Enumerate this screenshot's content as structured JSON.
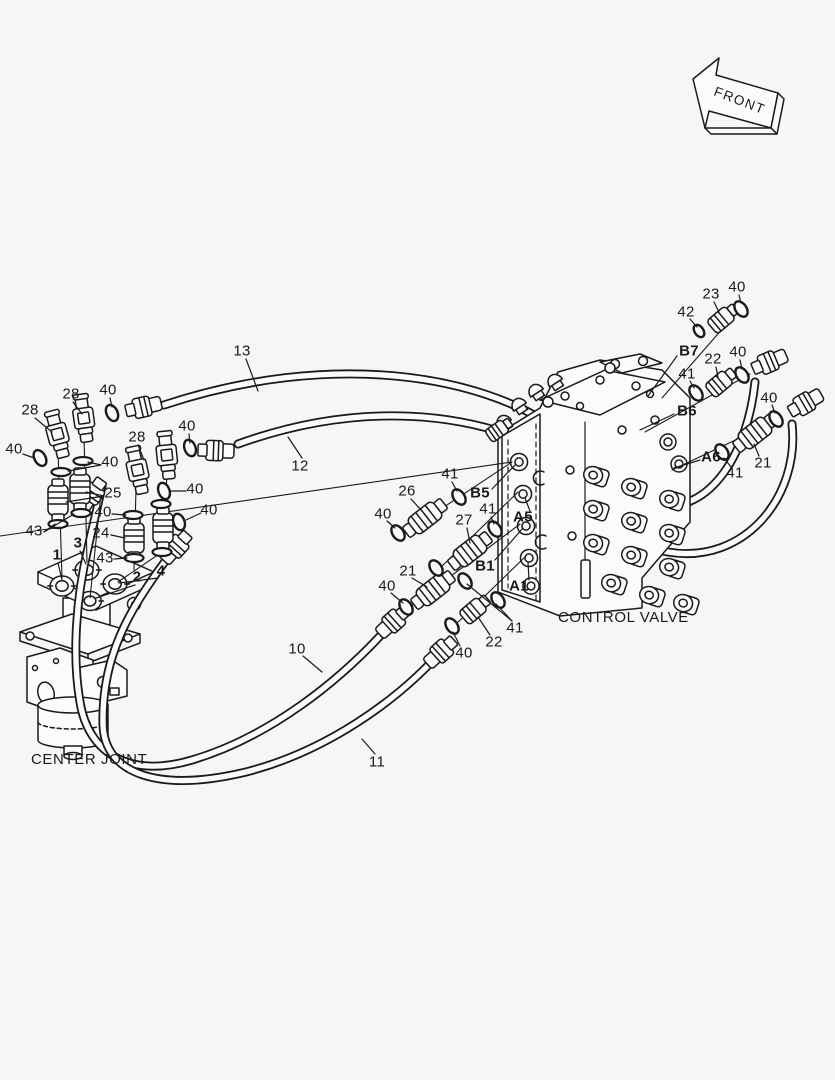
{
  "annotations": {
    "front_arrow": "FRONT",
    "center_joint": "CENTER JOINT",
    "control_valve": "CONTROL VALVE"
  },
  "colors": {
    "line": "#1a1a1a",
    "background": "#f6f6f4",
    "fill": "#fbfbfa"
  },
  "captions": [
    {
      "key": "center_joint",
      "text": "CENTER JOINT",
      "x": 31,
      "y": 752
    },
    {
      "key": "control_valve",
      "text": "CONTROL VALVE",
      "x": 558,
      "y": 610
    }
  ],
  "callouts": [
    {
      "text": "13",
      "x": 242,
      "y": 351,
      "bold": false
    },
    {
      "text": "12",
      "x": 300,
      "y": 466,
      "bold": false
    },
    {
      "text": "28",
      "x": 30,
      "y": 410,
      "bold": false
    },
    {
      "text": "28",
      "x": 71,
      "y": 394,
      "bold": false
    },
    {
      "text": "40",
      "x": 108,
      "y": 390,
      "bold": false
    },
    {
      "text": "40",
      "x": 14,
      "y": 449,
      "bold": false
    },
    {
      "text": "28",
      "x": 137,
      "y": 437,
      "bold": false
    },
    {
      "text": "40",
      "x": 187,
      "y": 426,
      "bold": false
    },
    {
      "text": "40",
      "x": 110,
      "y": 462,
      "bold": false
    },
    {
      "text": "25",
      "x": 113,
      "y": 493,
      "bold": false
    },
    {
      "text": "40",
      "x": 103,
      "y": 512,
      "bold": false
    },
    {
      "text": "24",
      "x": 101,
      "y": 533,
      "bold": false
    },
    {
      "text": "43",
      "x": 34,
      "y": 531,
      "bold": false
    },
    {
      "text": "43",
      "x": 105,
      "y": 558,
      "bold": false
    },
    {
      "text": "1",
      "x": 57,
      "y": 555,
      "bold": true
    },
    {
      "text": "3",
      "x": 78,
      "y": 543,
      "bold": true
    },
    {
      "text": "2",
      "x": 137,
      "y": 577,
      "bold": true
    },
    {
      "text": "4",
      "x": 161,
      "y": 571,
      "bold": true
    },
    {
      "text": "40",
      "x": 195,
      "y": 489,
      "bold": false
    },
    {
      "text": "40",
      "x": 209,
      "y": 510,
      "bold": false
    },
    {
      "text": "26",
      "x": 407,
      "y": 491,
      "bold": false
    },
    {
      "text": "41",
      "x": 450,
      "y": 474,
      "bold": false
    },
    {
      "text": "B5",
      "x": 480,
      "y": 493,
      "bold": true
    },
    {
      "text": "40",
      "x": 383,
      "y": 514,
      "bold": false
    },
    {
      "text": "27",
      "x": 464,
      "y": 520,
      "bold": false
    },
    {
      "text": "41",
      "x": 488,
      "y": 509,
      "bold": false
    },
    {
      "text": "A5",
      "x": 523,
      "y": 517,
      "bold": true
    },
    {
      "text": "21",
      "x": 408,
      "y": 571,
      "bold": false
    },
    {
      "text": "40",
      "x": 387,
      "y": 586,
      "bold": false
    },
    {
      "text": "B1",
      "x": 485,
      "y": 566,
      "bold": true
    },
    {
      "text": "A1",
      "x": 519,
      "y": 586,
      "bold": true
    },
    {
      "text": "41",
      "x": 515,
      "y": 628,
      "bold": false
    },
    {
      "text": "22",
      "x": 494,
      "y": 642,
      "bold": false
    },
    {
      "text": "40",
      "x": 464,
      "y": 653,
      "bold": false
    },
    {
      "text": "10",
      "x": 297,
      "y": 649,
      "bold": false
    },
    {
      "text": "11",
      "x": 377,
      "y": 762,
      "bold": false
    },
    {
      "text": "42",
      "x": 686,
      "y": 312,
      "bold": false
    },
    {
      "text": "23",
      "x": 711,
      "y": 294,
      "bold": false
    },
    {
      "text": "40",
      "x": 737,
      "y": 287,
      "bold": false
    },
    {
      "text": "B7",
      "x": 689,
      "y": 351,
      "bold": true
    },
    {
      "text": "22",
      "x": 713,
      "y": 359,
      "bold": false
    },
    {
      "text": "40",
      "x": 738,
      "y": 352,
      "bold": false
    },
    {
      "text": "41",
      "x": 687,
      "y": 374,
      "bold": false
    },
    {
      "text": "B6",
      "x": 687,
      "y": 411,
      "bold": true
    },
    {
      "text": "40",
      "x": 769,
      "y": 398,
      "bold": false
    },
    {
      "text": "A6",
      "x": 711,
      "y": 457,
      "bold": true
    },
    {
      "text": "41",
      "x": 735,
      "y": 473,
      "bold": false
    },
    {
      "text": "21",
      "x": 763,
      "y": 463,
      "bold": false
    }
  ]
}
